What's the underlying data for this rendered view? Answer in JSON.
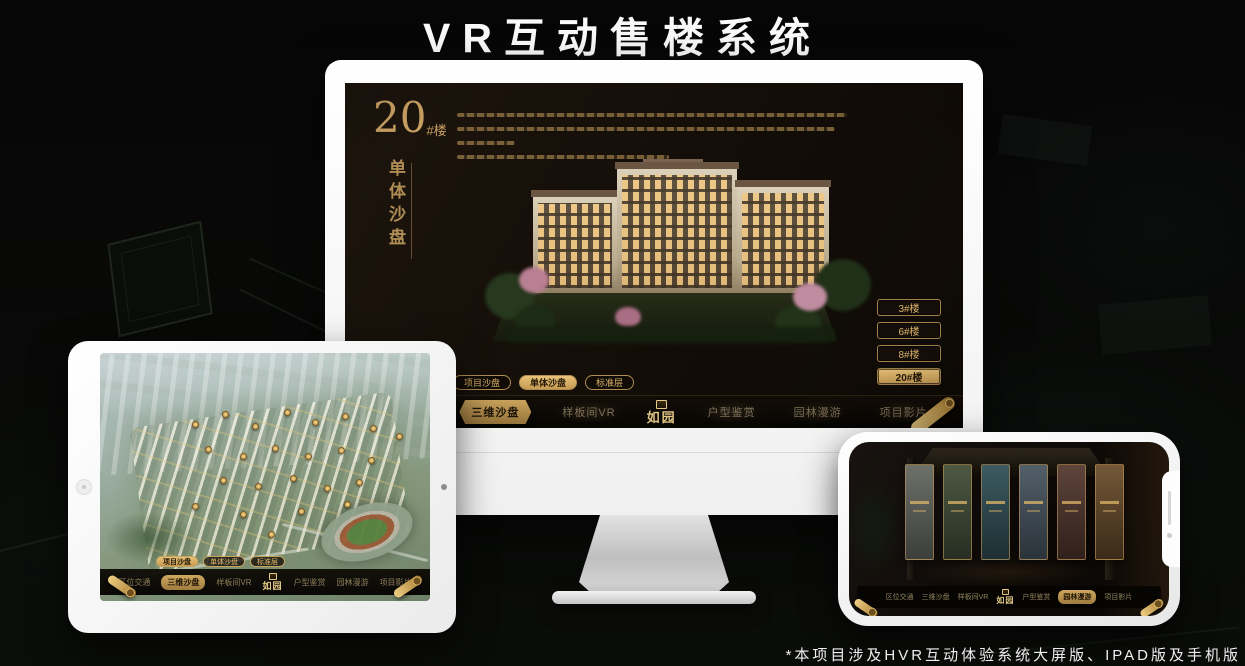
{
  "page": {
    "title": "VR互动售楼系统",
    "footnote": "*本项目涉及HVR互动体验系统大屏版、IPAD版及手机版"
  },
  "colors": {
    "gold": "#c9a063",
    "gold_bright": "#e8c278",
    "screen_dark": "#130d08",
    "monitor_body": "#f5f5f5"
  },
  "brand": {
    "logo": "如园"
  },
  "menu": {
    "nav_items": [
      "区位交通",
      "三维沙盘",
      "样板间VR",
      "户型鉴赏",
      "园林漫游",
      "项目影片"
    ],
    "sub_tabs": [
      "项目沙盘",
      "单体沙盘",
      "标准层"
    ]
  },
  "monitor": {
    "headline": {
      "number": "20",
      "suffix": "#楼",
      "vertical_title": "单体沙盘"
    },
    "floor_buttons": [
      {
        "label": "3#楼"
      },
      {
        "label": "6#楼"
      },
      {
        "label": "8#楼"
      },
      {
        "label": "20#楼"
      }
    ],
    "active_floor": "20#楼",
    "active_sub_tab": "单体沙盘",
    "active_nav": "三维沙盘"
  },
  "tablet": {
    "active_sub_tab": "项目沙盘",
    "active_nav": "三维沙盘"
  },
  "phone": {
    "active_nav": "园林漫游",
    "gallery_card_count": 6
  }
}
